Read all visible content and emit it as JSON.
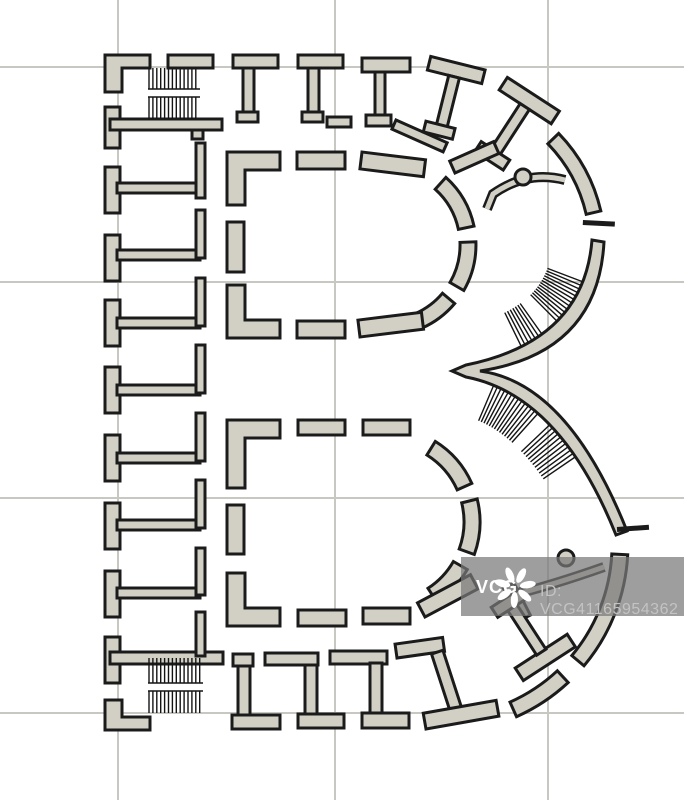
{
  "figure": {
    "kind": "architectural floor plan illustration",
    "subject": "ground plan shaped as the capital letter B"
  },
  "watermark": {
    "brand": "VCG",
    "id_text": "ID: VCG41165954362"
  },
  "colors": {
    "background": "#ffffff",
    "wall_fill": "#d2d0c5",
    "wall_outline": "#1b1b1b",
    "grid_line": "#c8c8c3",
    "hatch": "#141414",
    "watermark_band": "rgba(120,120,120,0.72)",
    "watermark_brand_text": "#ffffff",
    "watermark_id_text": "#c3c3c3"
  }
}
